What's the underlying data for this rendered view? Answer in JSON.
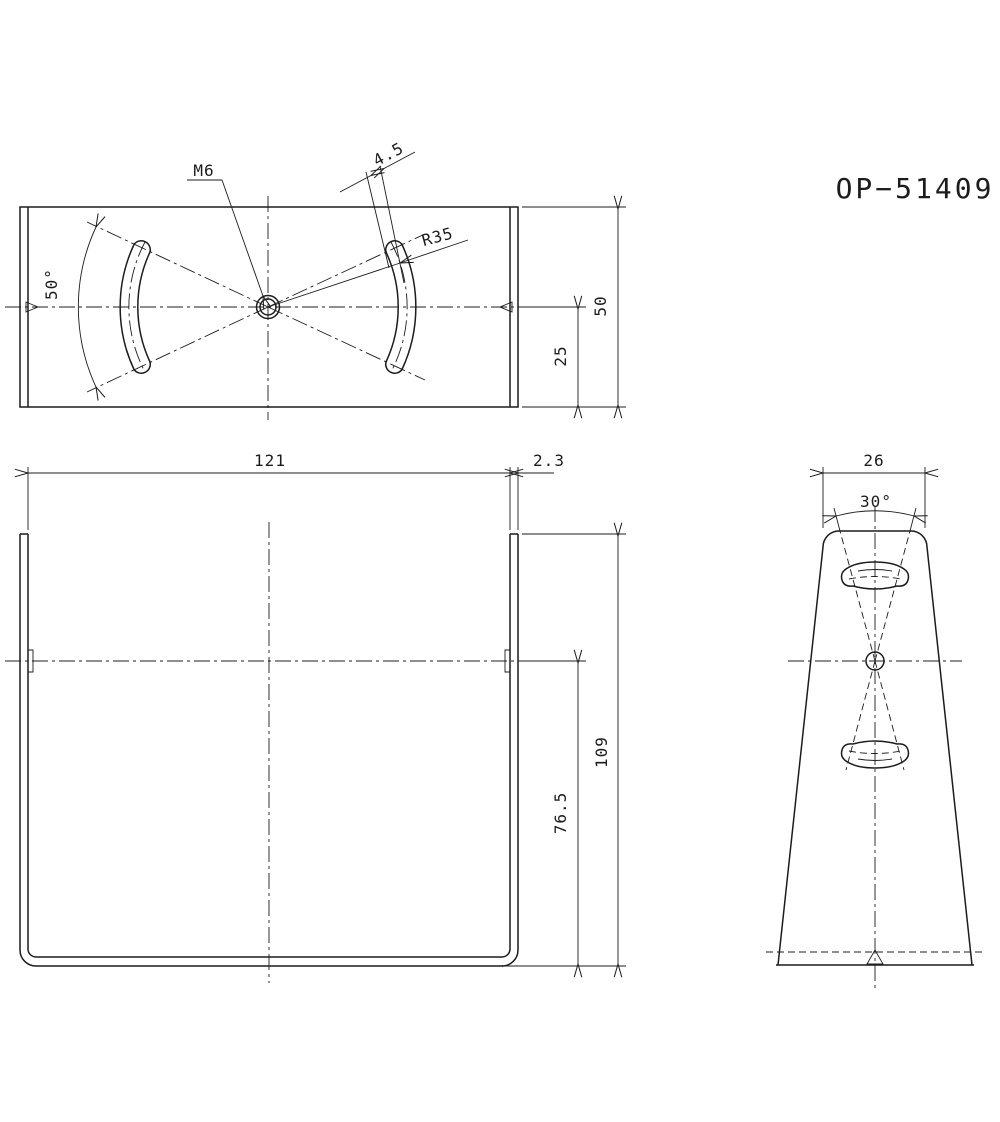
{
  "title": "OP−51409",
  "top_view": {
    "thread_label": "M6",
    "slot_width": "4.5",
    "slot_radius": "R35",
    "slot_angle": "50°",
    "depth": "50",
    "center_to_bottom": "25"
  },
  "front_view": {
    "width": "121",
    "thickness": "2.3",
    "height": "109",
    "center_height": "76.5"
  },
  "side_view": {
    "top_width": "26",
    "slot_cone_angle": "30°"
  }
}
